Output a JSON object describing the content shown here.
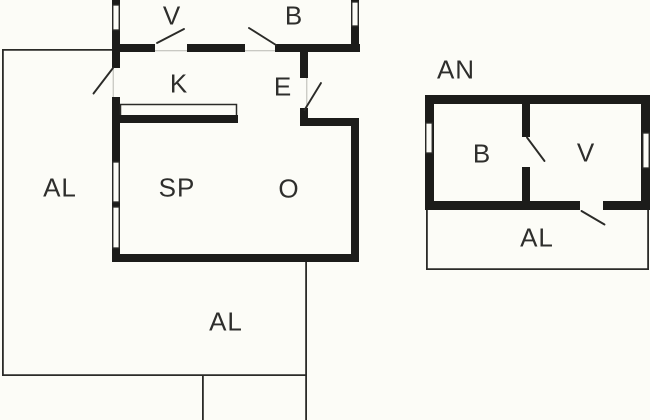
{
  "labels": {
    "main": {
      "v": "V",
      "b": "B",
      "k": "K",
      "e": "E",
      "sp": "SP",
      "o": "O",
      "al_left": "AL",
      "al_bottom": "AL"
    },
    "annex": {
      "title": "AN",
      "b": "B",
      "v": "V",
      "al": "AL"
    }
  },
  "colors": {
    "wall": "#1c1c1a",
    "thin_line": "#2b2b28",
    "background": "#fcfcf7",
    "label_text": "#2e2e2c"
  }
}
